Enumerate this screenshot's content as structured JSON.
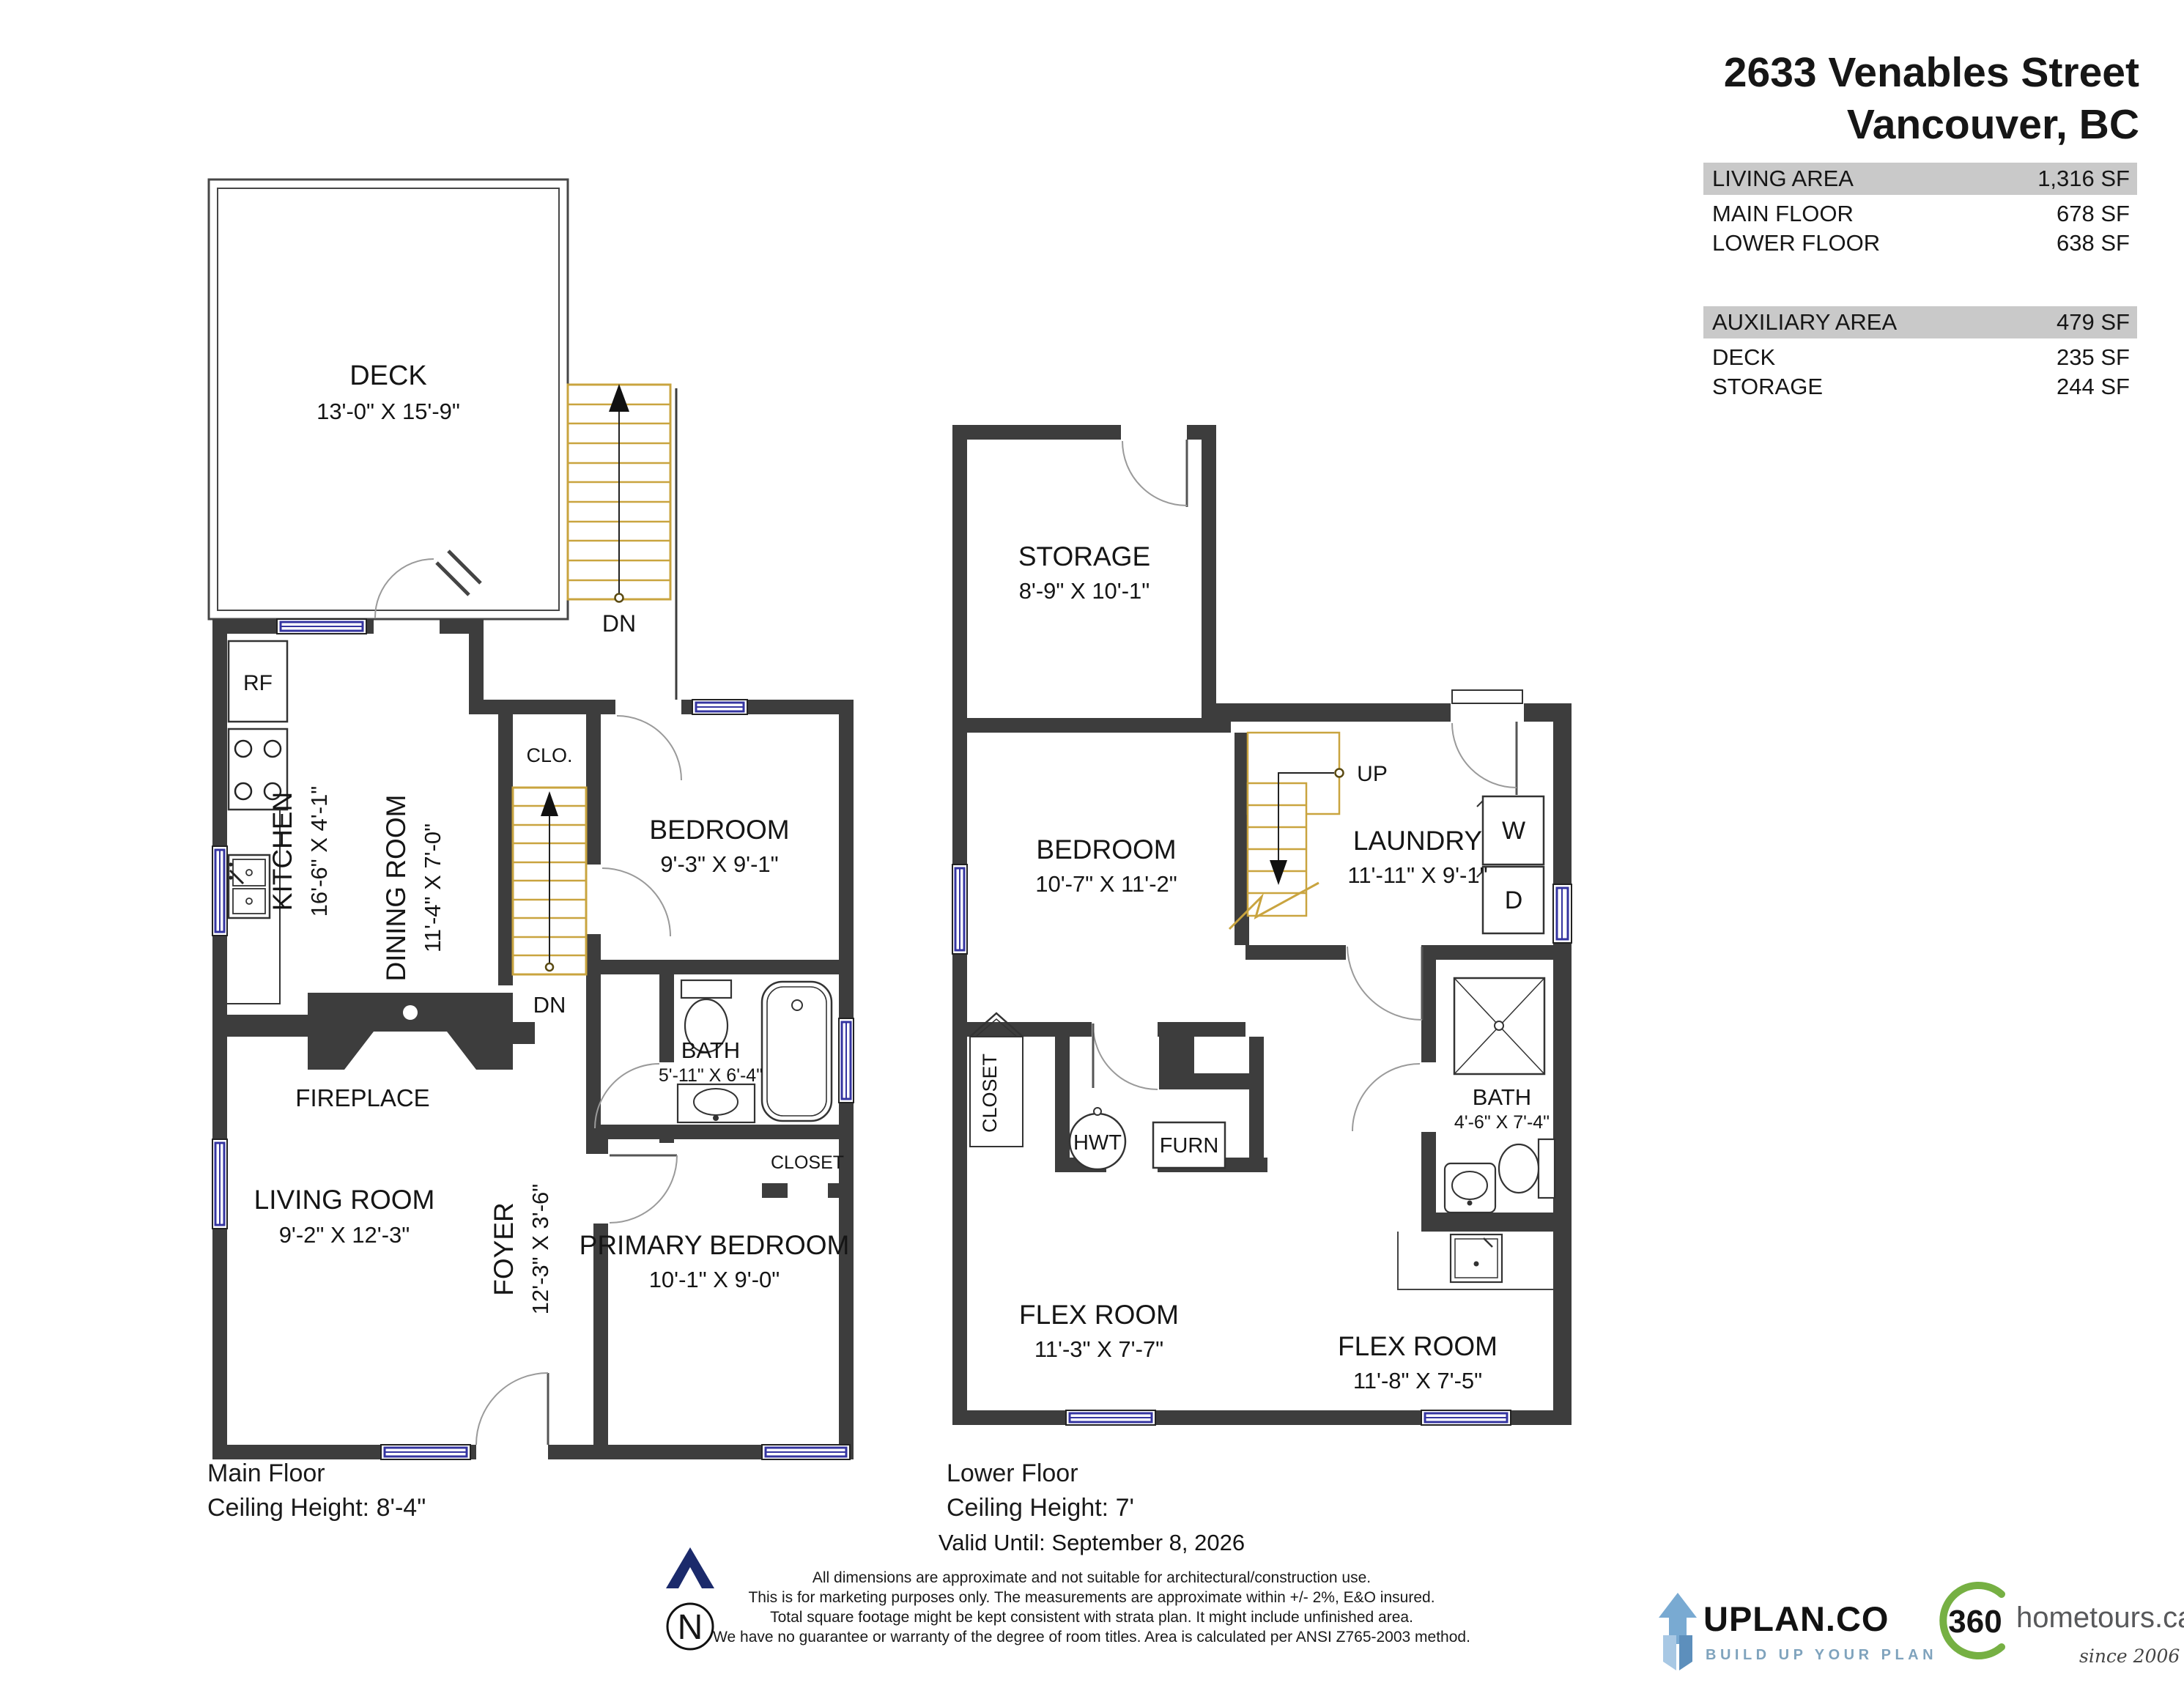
{
  "header": {
    "address_line1": "2633 Venables Street",
    "address_line2": "Vancouver, BC"
  },
  "area_table": {
    "row_living_label": "LIVING AREA",
    "row_living_value": "1,316 SF",
    "row_main_label": "MAIN FLOOR",
    "row_main_value": "678 SF",
    "row_lower_label": "LOWER FLOOR",
    "row_lower_value": "638 SF",
    "row_aux_label": "AUXILIARY AREA",
    "row_aux_value": "479 SF",
    "row_deck_label": "DECK",
    "row_deck_value": "235 SF",
    "row_storage_label": "STORAGE",
    "row_storage_value": "244 SF"
  },
  "main_floor": {
    "title": "Main Floor",
    "ceiling": "Ceiling Height: 8'-4\"",
    "deck_name": "DECK",
    "deck_dims": "13'-0\"  X  15'-9\"",
    "kitchen_name": "KITCHEN",
    "kitchen_dims": "16'-6\"  X  4'-1\"",
    "dining_name": "DINING ROOM",
    "dining_dims": "11'-4\"  X  7'-0\"",
    "bedroom_name": "BEDROOM",
    "bedroom_dims": "9'-3\"  X  9'-1\"",
    "bath_name": "BATH",
    "bath_dims": "5'-11\" X 6'-4\"",
    "living_name": "LIVING ROOM",
    "living_dims": "9'-2\"  X  12'-3\"",
    "foyer_name": "FOYER",
    "foyer_dims": "12'-3\"  X  3'-6\"",
    "primary_name": "PRIMARY BEDROOM",
    "primary_dims": "10'-1\"  X  9'-0\"",
    "rf": "RF",
    "clo": "CLO.",
    "closet": "CLOSET",
    "fireplace": "FIREPLACE",
    "dn_exterior": "DN",
    "dn_interior": "DN"
  },
  "lower_floor": {
    "title": "Lower Floor",
    "ceiling": "Ceiling Height: 7'",
    "storage_name": "STORAGE",
    "storage_dims": "8'-9\"  X  10'-1\"",
    "bedroom_name": "BEDROOM",
    "bedroom_dims": "10'-7\"  X  11'-2\"",
    "laundry_name": "LAUNDRY",
    "laundry_dims": "11'-11\" X  9'-1\"",
    "bath_name": "BATH",
    "bath_dims": "4'-6\" X 7'-4\"",
    "flex1_name": "FLEX ROOM",
    "flex1_dims": "11'-3\"  X  7'-7\"",
    "flex2_name": "FLEX ROOM",
    "flex2_dims": "11'-8\"  X  7'-5\"",
    "closet": "CLOSET",
    "hwt": "HWT",
    "furn": "FURN",
    "washer": "W",
    "dryer": "D",
    "up": "UP"
  },
  "footer": {
    "valid_until": "Valid Until: September 8, 2026",
    "north": "N",
    "disclaimer": [
      "All dimensions are approximate and not suitable for architectural/construction use.",
      "This is for marketing purposes only. The measurements are approximate within +/- 2%, E&O insured.",
      "Total square footage might be kept consistent with strata plan. It might include unfinished area.",
      "We have no guarantee or warranty of the degree of room titles. Area is calculated per ANSI Z765-2003 method."
    ]
  },
  "logos": {
    "uplan_name": "UPLAN.CO",
    "uplan_tagline": "BUILD UP YOUR PLAN",
    "tours_360": "360",
    "tours_domain": "hometours.ca",
    "tours_since": "since 2006"
  },
  "colors": {
    "wall": "#3d3d3d",
    "stair_gold": "#c9a43f",
    "window_blue": "#3434a0",
    "table_gray": "#c9c9c9",
    "north_navy": "#1b2a6b",
    "uplan_blue": "#79aad2",
    "green_360": "#76b043"
  }
}
